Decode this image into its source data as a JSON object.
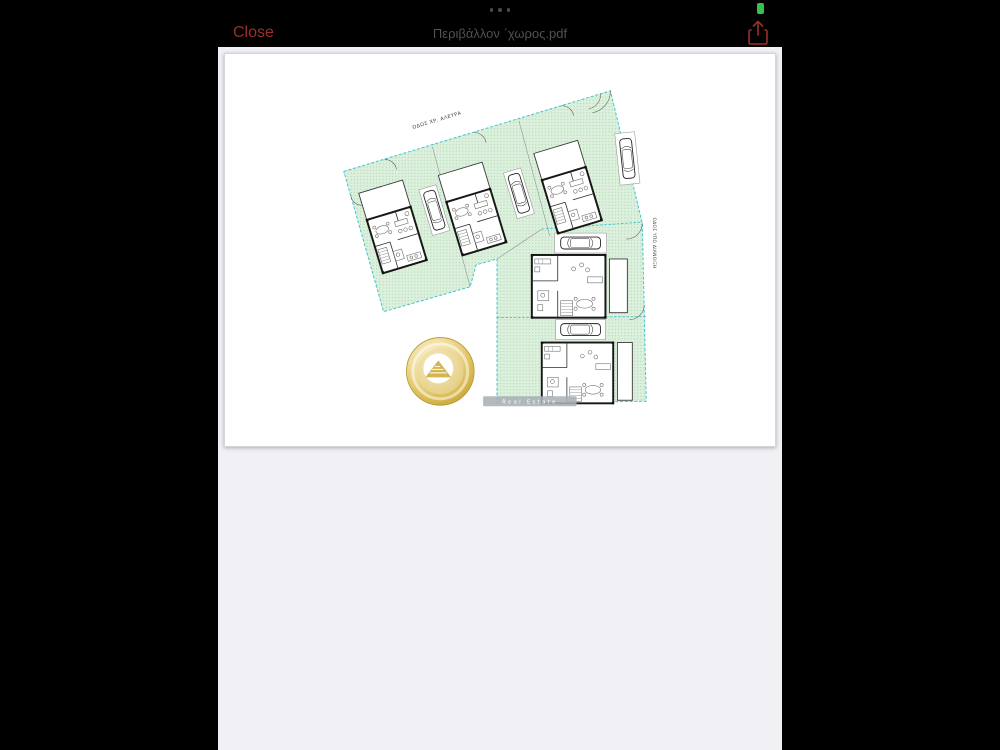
{
  "status_bar": {
    "multitask_indicator_icon": "ellipsis-icon",
    "battery_icon": "battery-icon",
    "battery_color": "#35c24c"
  },
  "toolbar": {
    "close_label": "Close",
    "title": "Περιβάλλον ΄χωρος.pdf",
    "share_icon": "share-icon",
    "accent_color": "#9b2f2a",
    "title_color": "#515154"
  },
  "plan": {
    "street_top": "ΟΔΟΣ ΧΡ. ΑΛΕΥΡΑ",
    "street_right": "ΟΔΟΣ ΥΠΟ ΔΙΑΝΟΙΞΗ",
    "watermark": "Real Estate",
    "houses_count": "5",
    "cars_count": "5",
    "colors": {
      "boundary_cyan": "#3fc6d2",
      "lawn_green": "#ddf0dd",
      "lawn_dot_green": "#a3d6a9",
      "wall_black": "#181818",
      "logo_gold": "#d8ba50"
    }
  }
}
